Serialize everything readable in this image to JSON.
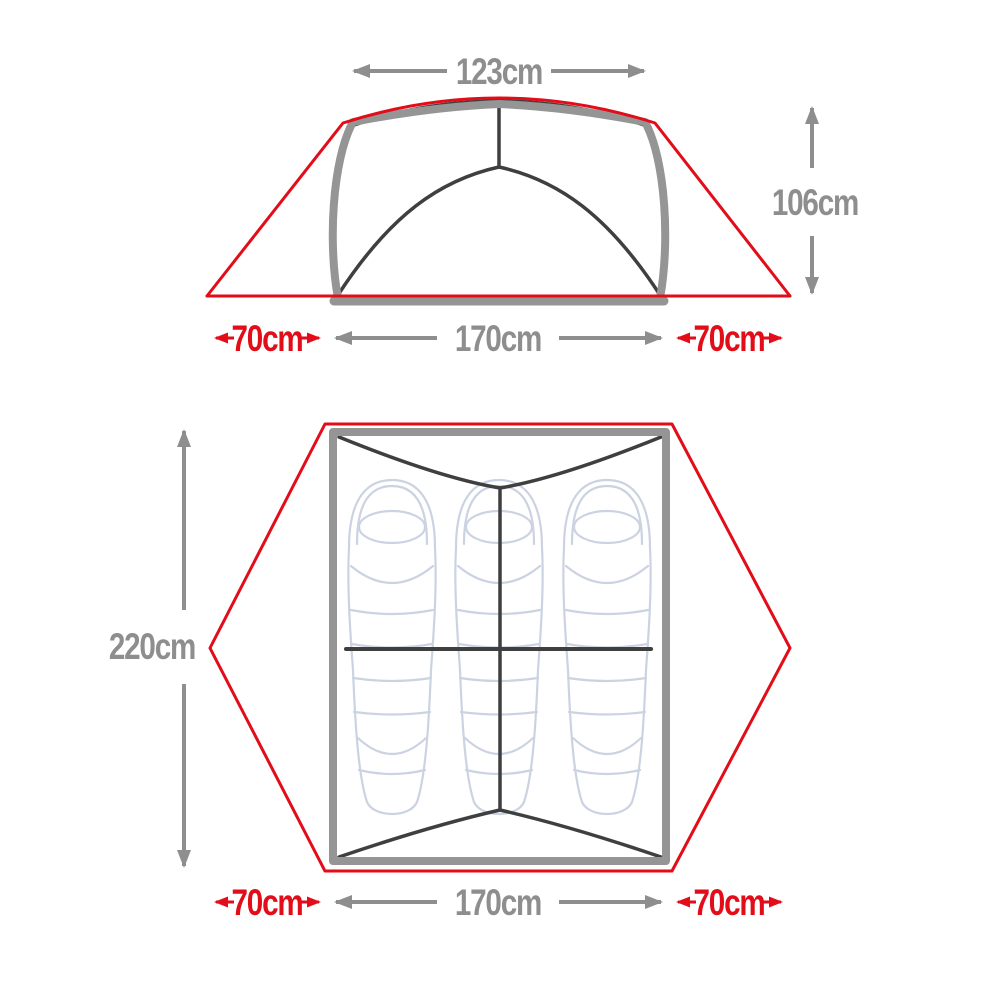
{
  "diagram_title": "tent-dimensions",
  "colors": {
    "rainfly_red": "#e20d18",
    "dimension_gray": "#8e8e8e",
    "inner_tent_dark": "#3f3f3f",
    "frame_gray": "#959595",
    "sleeping_bag_outline": "#cbd3e2",
    "background": "#ffffff"
  },
  "front_view": {
    "labels": {
      "top_width": "123cm",
      "height": "106cm",
      "floor_width": "170cm",
      "vestibule_left": "70cm",
      "vestibule_right": "70cm"
    }
  },
  "floor_plan": {
    "labels": {
      "length": "220cm",
      "floor_width": "170cm",
      "vestibule_left": "70cm",
      "vestibule_right": "70cm"
    },
    "sleeping_bag_count": 3
  }
}
